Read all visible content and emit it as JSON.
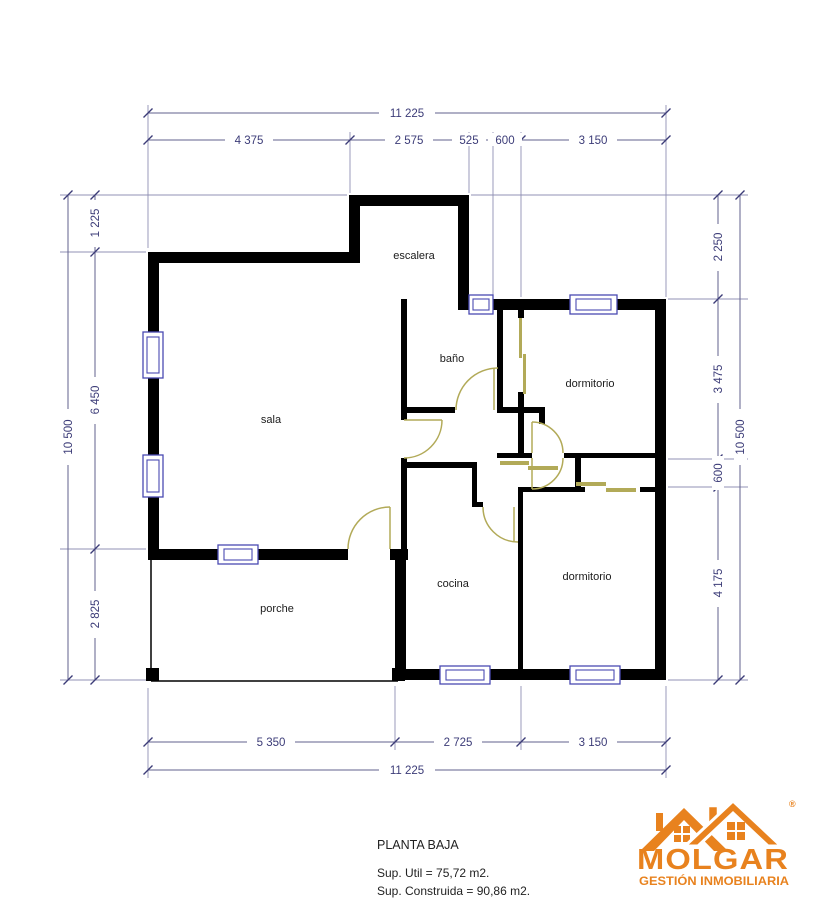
{
  "plan": {
    "rooms": {
      "escalera": "escalera",
      "sala": "sala",
      "bano": "baño",
      "dormitorio1": "dormitorio",
      "cocina": "cocina",
      "dormitorio2": "dormitorio",
      "porche": "porche"
    }
  },
  "dimensions": {
    "top_total": "11 225",
    "top": [
      "4 375",
      "2 575",
      "525",
      "600",
      "3 150"
    ],
    "left_total": "10 500",
    "left": [
      "1 225",
      "6 450",
      "2 825"
    ],
    "right_total": "10 500",
    "right": [
      "2 250",
      "3 475",
      "600",
      "4 175"
    ],
    "bottom": [
      "5 350",
      "2 725",
      "3 150"
    ],
    "bottom_total": "11 225"
  },
  "footer": {
    "title": "PLANTA BAJA",
    "sup_util": "Sup. Util = 75,72 m2.",
    "sup_construida": "Sup. Construida = 90,86 m2."
  },
  "logo": {
    "name": "MOLGAR",
    "tagline": "GESTIÓN INMOBILIARIA",
    "registered": "®"
  },
  "colors": {
    "wall": "#000000",
    "dimension": "#3C3C78",
    "window": "#4A4AB2",
    "door": "#B2AA58",
    "logo": "#E8821E"
  }
}
